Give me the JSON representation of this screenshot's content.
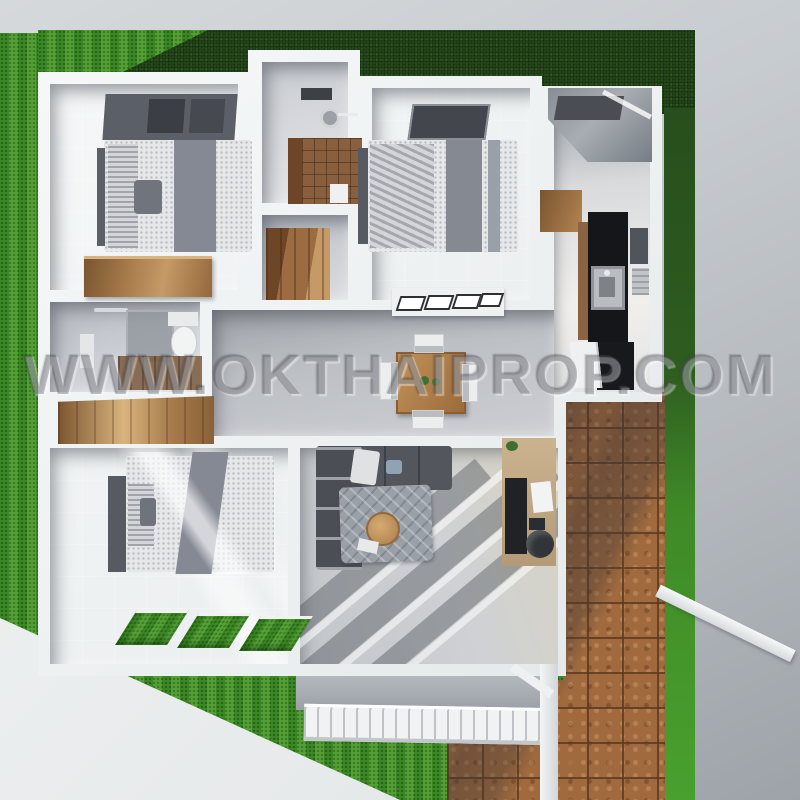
{
  "watermark": {
    "text": "WWW.OKTHAIPROP.COM"
  },
  "palette": {
    "background_gray": "#c7ccd0",
    "lawn_light_green": "#47992b",
    "lawn_dark_green": "#254a1b",
    "wall_white": "#f1f3f4",
    "floor_gray": "#c8cbd1",
    "wood_brown": "#a87c4c",
    "terracotta_tile": "#a06a3e",
    "kitchen_black": "#141619",
    "sofa_charcoal": "#53565c",
    "blanket_gray": "#858a93"
  },
  "scene": {
    "view": "top-down 3D dollhouse floor-plan render",
    "rooms": [
      {
        "name": "bedroom-1",
        "furniture": [
          "double-bed",
          "dark-headboard-panel",
          "wooden-dresser"
        ]
      },
      {
        "name": "bathroom-1",
        "furniture": [
          "rain-shower-slab",
          "shower-head",
          "brown-tile-wall",
          "shower-tray"
        ]
      },
      {
        "name": "wardrobe-nook",
        "furniture": [
          "wooden-wardrobe"
        ]
      },
      {
        "name": "bedroom-2",
        "furniture": [
          "double-bed",
          "window-slab",
          "louvered-desk"
        ]
      },
      {
        "name": "kitchen-entry",
        "furniture": [
          "entry-canopy",
          "wood-upper-cabinet",
          "black-kitchen-unit",
          "stainless-sink",
          "wall-panels",
          "black-cabinet",
          "white-door-panel"
        ]
      },
      {
        "name": "bathroom-2",
        "furniture": [
          "towel-bar",
          "glass-partition",
          "toilet",
          "wall-shelf",
          "brown-tile-band"
        ]
      },
      {
        "name": "dining-area",
        "furniture": [
          "wood-dining-table",
          "white-chair-x4",
          "plant-centerpiece",
          "wooden-sideboard"
        ]
      },
      {
        "name": "bedroom-3",
        "furniture": [
          "double-bed",
          "grass-floor-vents-x3"
        ]
      },
      {
        "name": "living-room",
        "furniture": [
          "l-shaped-sofa",
          "patterned-rug",
          "round-tray-table",
          "computer-desk",
          "monitor",
          "office-chair",
          "sunlight-beams"
        ]
      }
    ],
    "exterior": [
      "left-lawn",
      "back-lawn",
      "right-lawn-strip",
      "terracotta-patio",
      "white-driveway",
      "porch-slab",
      "pergola-slat-gate",
      "porch-post",
      "fence-beam"
    ]
  }
}
